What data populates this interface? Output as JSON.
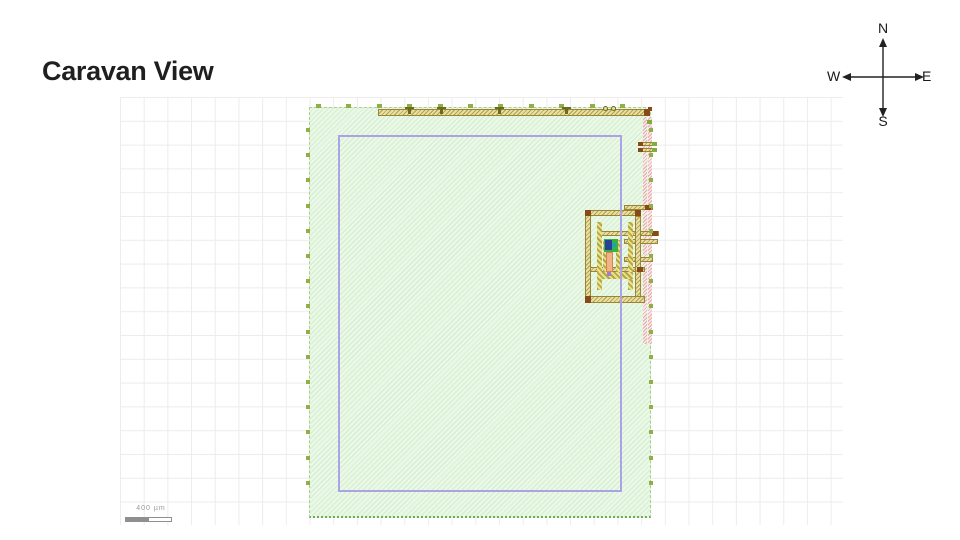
{
  "page": {
    "title": "Caravan View"
  },
  "compass": {
    "north": "N",
    "south": "S",
    "east": "E",
    "west": "W"
  },
  "scalebar": {
    "label": "400 µm"
  },
  "canvas_colors": {
    "grid_color": "#ececec",
    "die_fill": "#eaf8e7",
    "die_hatch": "#d5eecd",
    "die_border": "#a6cf8c",
    "core_boundary_color": "#aca2e6",
    "pad_color": "#8fb046",
    "metal_fill": "#e8dfa8",
    "metal_hatch": "#b3a145",
    "metal_border": "#9a8435",
    "via_cap_color": "#87491a",
    "strip_fill": "#fbecec",
    "strip_hatch": "#e6a8a8",
    "core_green": "#3cb043",
    "core_navy": "#2b3f96",
    "core_teal": "#12a7b5",
    "core_salmon": "#f2b285"
  }
}
